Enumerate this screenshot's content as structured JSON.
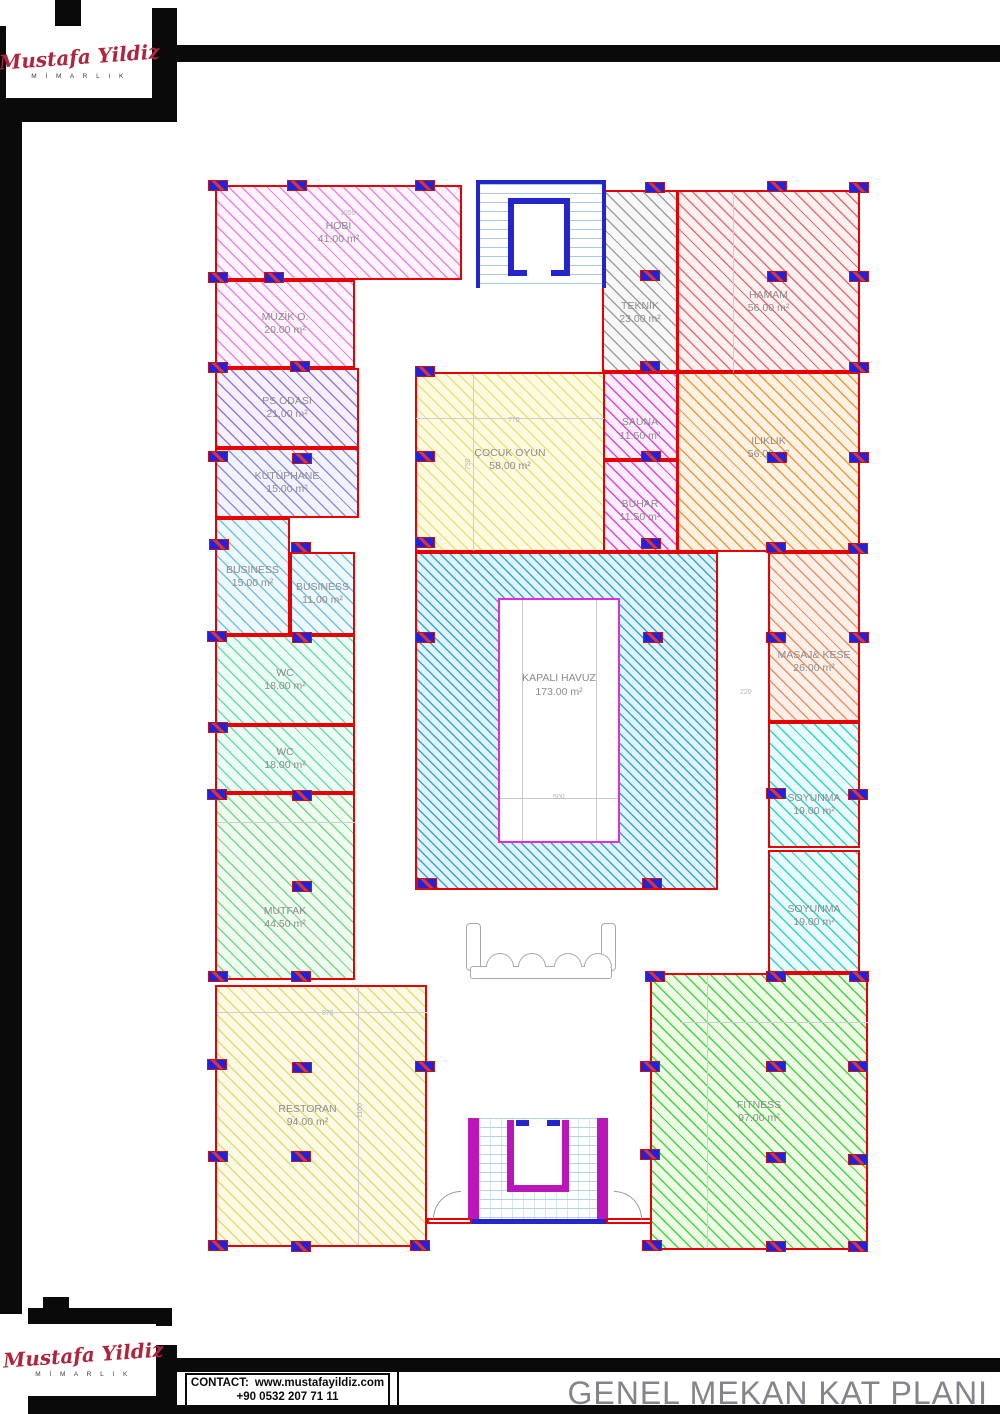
{
  "logo": {
    "name": "Mustafa Yildiz",
    "subtitle": "M İ M A R L I K",
    "color": "#b0243c"
  },
  "footer": {
    "contact_label": "CONTACT:",
    "website": "www.mustafayildiz.com",
    "phone": "+90 0532 207 71 11",
    "title": "GENEL MEKAN KAT PLANI",
    "title_color": "#84848c"
  },
  "plan": {
    "wall_color": "#e80000",
    "column_color": "#2222dd",
    "label_color": "#8c8c8c",
    "pool": {
      "name": "KAPALI HAVUZ",
      "area": "173.00 m²"
    },
    "rooms": [
      {
        "id": "hobi",
        "name": "HOBİ",
        "area": "41.00 m²",
        "x": 215,
        "y": 185,
        "w": 247,
        "h": 95,
        "line": "#ef82e6",
        "bg": "#fdf4fd"
      },
      {
        "id": "muzik-odasi",
        "name": "MÜZİK O.",
        "area": "20.00 m²",
        "x": 215,
        "y": 280,
        "w": 140,
        "h": 88,
        "line": "#ef82e6",
        "bg": "#fdf4fd"
      },
      {
        "id": "ps-odasi",
        "name": "PS ODASI",
        "area": "21.00 m²",
        "x": 215,
        "y": 368,
        "w": 144,
        "h": 80,
        "line": "#9b74e4",
        "bg": "#f6f2fd"
      },
      {
        "id": "kutuphane",
        "name": "KÜTÜPHANE",
        "area": "15.00 m²",
        "x": 215,
        "y": 448,
        "w": 144,
        "h": 70,
        "line": "#8d8dee",
        "bg": "#f3f3fe"
      },
      {
        "id": "business-15",
        "name": "BUSINESS",
        "area": "15.00 m²",
        "x": 215,
        "y": 518,
        "w": 75,
        "h": 117,
        "line": "#6ec4ea",
        "bg": "#eef8fd"
      },
      {
        "id": "business-11",
        "name": "BUSINESS",
        "area": "11.00 m²",
        "x": 290,
        "y": 552,
        "w": 65,
        "h": 83,
        "line": "#6ec4ea",
        "bg": "#eef8fd"
      },
      {
        "id": "wc-1",
        "name": "WC",
        "area": "18.00 m²",
        "x": 215,
        "y": 635,
        "w": 140,
        "h": 90,
        "line": "#63dfb2",
        "bg": "#eefcf6"
      },
      {
        "id": "wc-2",
        "name": "WC",
        "area": "18.00 m²",
        "x": 215,
        "y": 725,
        "w": 140,
        "h": 68,
        "line": "#63dfb2",
        "bg": "#eefcf6"
      },
      {
        "id": "mutfak",
        "name": "MUTFAK",
        "area": "44.50 m²",
        "x": 215,
        "y": 793,
        "w": 140,
        "h": 187,
        "line": "#74db83",
        "bg": "#effbf1",
        "ly": 0.67
      },
      {
        "id": "restoran",
        "name": "RESTORAN",
        "area": "94.00 m²",
        "x": 215,
        "y": 985,
        "w": 212,
        "h": 262,
        "line": "#e4dc6c",
        "bg": "#fbfae6",
        "lx": 0.37
      },
      {
        "id": "teknik",
        "name": "TEKNİK",
        "area": "23.00 m²",
        "x": 602,
        "y": 190,
        "w": 76,
        "h": 182,
        "line": "#a0a0a0",
        "bg": "#f7f7f7",
        "ly": 0.68
      },
      {
        "id": "hamam",
        "name": "HAMAM",
        "area": "56.00 m²",
        "x": 677,
        "y": 190,
        "w": 183,
        "h": 182,
        "line": "#f26b6b",
        "bg": "#fdf1f1",
        "ly": 0.62
      },
      {
        "id": "sauna",
        "name": "SAUNA",
        "area": "11.50 m²",
        "x": 602,
        "y": 372,
        "w": 76,
        "h": 88,
        "line": "#e243e2",
        "bg": "#fceefc",
        "ly": 0.66
      },
      {
        "id": "buhar",
        "name": "BUHAR",
        "area": "11.50 m²",
        "x": 602,
        "y": 460,
        "w": 76,
        "h": 92,
        "line": "#e243e2",
        "bg": "#fceefc",
        "ly": 0.56
      },
      {
        "id": "iliklik",
        "name": "ILIKLIK",
        "area": "56.00 m²",
        "x": 677,
        "y": 372,
        "w": 183,
        "h": 180,
        "line": "#f19a39",
        "bg": "#fdf2e4",
        "ly": 0.42
      },
      {
        "id": "cocuk-oyun",
        "name": "ÇOCUK OYUN",
        "area": "58.00 m²",
        "x": 415,
        "y": 372,
        "w": 190,
        "h": 180,
        "line": "#e9e276",
        "bg": "#fcfbe2",
        "ly": 0.49
      },
      {
        "id": "kapali-havuz-hall",
        "x": 415,
        "y": 552,
        "w": 303,
        "h": 338,
        "line": "#2fa9da",
        "bg": "#e2f3fb",
        "gap": 7
      },
      {
        "id": "masaj-kese",
        "name": "MASAJ& KESE",
        "area": "26.00 m²",
        "x": 768,
        "y": 552,
        "w": 92,
        "h": 170,
        "line": "#f18e64",
        "bg": "#fdf0e9",
        "ly": 0.65
      },
      {
        "id": "soyunma-1",
        "name": "SOYUNMA",
        "area": "19.00 m²",
        "x": 768,
        "y": 722,
        "w": 92,
        "h": 126,
        "line": "#2ed2d2",
        "bg": "#e9fbfb",
        "ly": 0.66
      },
      {
        "id": "soyunma-2",
        "name": "SOYUNMA",
        "area": "19.00 m²",
        "x": 768,
        "y": 850,
        "w": 92,
        "h": 123,
        "line": "#2ed2d2",
        "bg": "#e9fbfb",
        "ly": 0.54
      },
      {
        "id": "fitness",
        "name": "FITNESS",
        "area": "97.00 m²",
        "x": 650,
        "y": 973,
        "w": 218,
        "h": 277,
        "line": "#3fd83f",
        "bg": "#eefce6"
      }
    ],
    "columns": [
      [
        218,
        186
      ],
      [
        297,
        186
      ],
      [
        425,
        186
      ],
      [
        655,
        188
      ],
      [
        777,
        187
      ],
      [
        859,
        188
      ],
      [
        218,
        278
      ],
      [
        274,
        278
      ],
      [
        650,
        276
      ],
      [
        777,
        277
      ],
      [
        859,
        277
      ],
      [
        218,
        368
      ],
      [
        300,
        367
      ],
      [
        425,
        372
      ],
      [
        650,
        367
      ],
      [
        859,
        368
      ],
      [
        218,
        457
      ],
      [
        302,
        459
      ],
      [
        425,
        457
      ],
      [
        651,
        457
      ],
      [
        777,
        458
      ],
      [
        859,
        458
      ],
      [
        219,
        545
      ],
      [
        301,
        548
      ],
      [
        425,
        543
      ],
      [
        651,
        544
      ],
      [
        776,
        548
      ],
      [
        858,
        549
      ],
      [
        217,
        637
      ],
      [
        302,
        638
      ],
      [
        425,
        638
      ],
      [
        653,
        638
      ],
      [
        776,
        638
      ],
      [
        859,
        638
      ],
      [
        218,
        728
      ],
      [
        217,
        795
      ],
      [
        302,
        796
      ],
      [
        776,
        794
      ],
      [
        858,
        795
      ],
      [
        302,
        887
      ],
      [
        427,
        884
      ],
      [
        652,
        884
      ],
      [
        218,
        977
      ],
      [
        301,
        977
      ],
      [
        655,
        977
      ],
      [
        776,
        977
      ],
      [
        859,
        977
      ],
      [
        217,
        1065
      ],
      [
        302,
        1068
      ],
      [
        425,
        1067
      ],
      [
        650,
        1067
      ],
      [
        776,
        1067
      ],
      [
        858,
        1067
      ],
      [
        218,
        1157
      ],
      [
        301,
        1157
      ],
      [
        650,
        1155
      ],
      [
        776,
        1158
      ],
      [
        858,
        1160
      ],
      [
        218,
        1246
      ],
      [
        301,
        1247
      ],
      [
        420,
        1246
      ],
      [
        652,
        1246
      ],
      [
        776,
        1247
      ],
      [
        858,
        1247
      ]
    ],
    "dims": [
      {
        "t": "1055",
        "x": 340,
        "y": 210
      },
      {
        "t": "875",
        "x": 322,
        "y": 1010
      },
      {
        "t": "1100",
        "x": 357,
        "y": 1118,
        "v": 1
      },
      {
        "t": "770",
        "x": 508,
        "y": 417
      },
      {
        "t": "750",
        "x": 465,
        "y": 470,
        "v": 1
      },
      {
        "t": "500",
        "x": 553,
        "y": 794
      },
      {
        "t": "220",
        "x": 740,
        "y": 689
      }
    ],
    "lines": [
      [
        358,
        987,
        1,
        258
      ],
      [
        707,
        975,
        1,
        272
      ],
      [
        733,
        192,
        1,
        181
      ],
      [
        416,
        418,
        188,
        1
      ],
      [
        473,
        374,
        1,
        177
      ],
      [
        217,
        1012,
        210,
        1
      ],
      [
        217,
        822,
        138,
        1
      ],
      [
        680,
        1022,
        188,
        1
      ]
    ]
  }
}
